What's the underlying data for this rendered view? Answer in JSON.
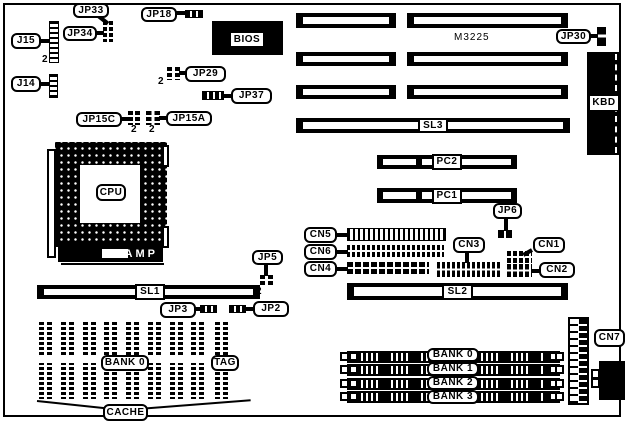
{
  "colors": {
    "ink": "#000000",
    "paper": "#ffffff"
  },
  "labels": {
    "jp33": "JP33",
    "jp34": "JP34",
    "j15": "J15",
    "j14": "J14",
    "jp18": "JP18",
    "bios": "BIOS",
    "jp29": "JP29",
    "jp37": "JP37",
    "jp15c": "JP15C",
    "jp15a": "JP15A",
    "m3225": "M3225",
    "jp30": "JP30",
    "kbd": "KBD",
    "sl3": "SL3",
    "cpu": "CPU",
    "amp": "AMP",
    "pc2": "PC2",
    "pc1": "PC1",
    "jp6": "JP6",
    "cn5": "CN5",
    "cn6": "CN6",
    "cn4": "CN4",
    "cn3": "CN3",
    "cn1": "CN1",
    "cn2": "CN2",
    "jp5": "JP5",
    "sl1": "SL1",
    "sl2": "SL2",
    "jp3": "JP3",
    "jp2": "JP2",
    "cache_bank": "BANK 0",
    "tag": "TAG",
    "cache": "CACHE",
    "simm_banks": [
      "BANK 0",
      "BANK 1",
      "BANK 2",
      "BANK 3"
    ],
    "cn7": "CN7",
    "pin2": "2"
  }
}
